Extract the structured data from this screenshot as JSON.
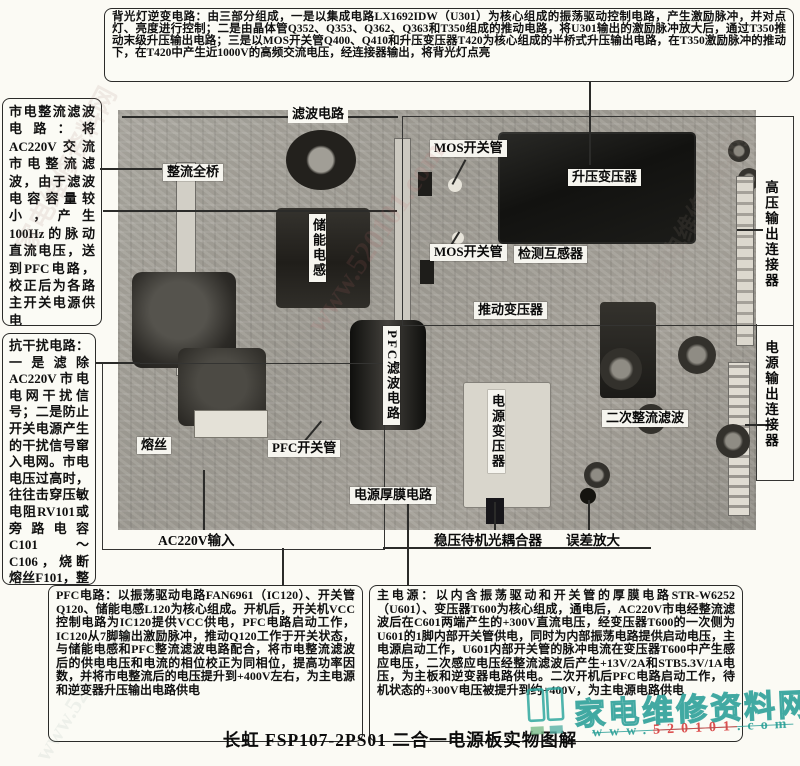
{
  "page": {
    "caption": "长虹 FSP107-2PS01 二合一电源板实物图解"
  },
  "watermark": {
    "site_name": "家电维修资料网",
    "url_prefix": "www.",
    "url_digits": "520101",
    "url_suffix": ".com",
    "faint_url": "www.520101.com",
    "teal": "#2fa79f",
    "red": "#d94040"
  },
  "annotations": {
    "backlight_inverter": "背光灯逆变电路：由三部分组成，一是以集成电路LX1692IDW（U301）为核心组成的振荡驱动控制电路，产生激励脉冲，并对点灯、亮度进行控制；二是由晶体管Q352、Q353、Q362、Q363和T350组成的推动电路，将U301输出的激励脉冲放大后，通过T350推动末级升压输出电路；三是以MOS开关管Q400、Q410和升压变压器T420为核心组成的半桥式升压输出电路，在T350激励脉冲的推动下，在T420中产生近1000V的高频交流电压，经连接器输出，将背光灯点亮",
    "mains_rectifier_filter": "市电整流滤波电路：将AC220V交流市电整流滤波，由于滤波电容容量较小，产生100Hz的脉动直流电压，送到PFC电路，校正后为各路主开关电源供电",
    "anti_interference": "抗干扰电路：一是滤除AC220V市电电网干扰信号；二是防止开关电源产生的干扰信号窜入电网。市电电压过高时，往往击穿压敏电阻RV101或旁路电容C101～C106，烧断熔丝F101，整机三无",
    "pfc_circuit": "PFC电路：以振荡驱动电路FAN6961（IC120）、开关管Q120、储能电感L120为核心组成。开机后，开关机VCC控制电路为IC120提供VCC供电，PFC电路启动工作，IC120从7脚输出激励脉冲，推动Q120工作于开关状态，与储能电感和PFC整流滤波电路配合，将市电整流滤波后的供电电压和电流的相位校正为同相位，提高功率因数，并将市电整流后的电压提升到+400V左右，为主电源和逆变器升压输出电路供电",
    "main_power": "主电源：以内含振荡驱动和开关管的厚膜电路STR-W6252（U601）、变压器T600为核心组成，通电后，AC220V市电经整流滤波后在C601两端产生的+300V直流电压，经变压器T600的一次侧为U601的1脚内部开关管供电，同时为内部振荡电路提供启动电压，主电源启动工作，U601内部开关管的脉冲电流在变压器T600中产生感应电压，二次感应电压经整流滤波后产生+13V/2A和STB5.3V/1A电压，为主板和逆变器电路供电。二次开机后PFC电路启动工作，待机状态的+300V电压被提升到约+400V，为主电源电路供电"
  },
  "board_labels": {
    "filter_circuit": "滤波电路",
    "rectifier_bridge": "整流全桥",
    "mos_switch_top": "MOS开关管",
    "boost_transformer": "升压变压器",
    "mos_switch_bottom": "MOS开关管",
    "detect_transformer": "检测互感器",
    "drive_transformer": "推动变压器",
    "storage_inductor": "储能电感",
    "pfc_filter": "PFC滤波电路",
    "pfc_switch": "PFC开关管",
    "fuse": "熔丝",
    "power_thick_film": "电源厚膜电路",
    "power_transformer": "电源变压器",
    "secondary_rectifier": "二次整流滤波",
    "hv_output_connector": "高压输出连接器",
    "power_output_connector": "电源输出连接器",
    "ac_input": "AC220V输入",
    "standby_optocoupler": "稳压待机光耦合器",
    "error_amplifier": "误差放大"
  }
}
